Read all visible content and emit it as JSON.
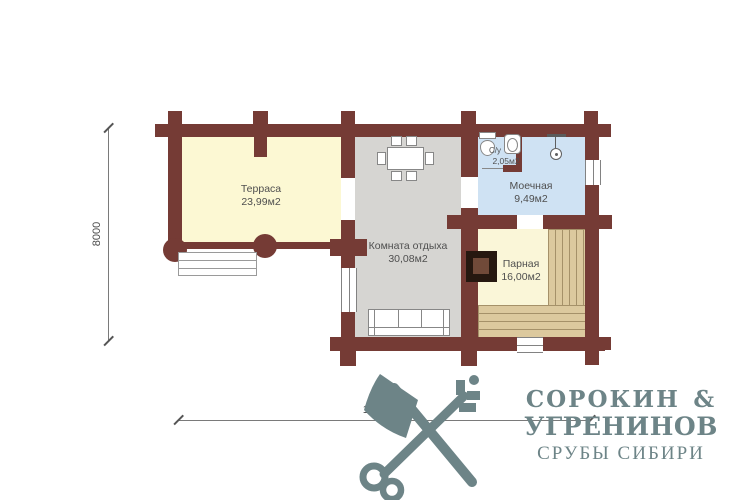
{
  "plan": {
    "rooms": [
      {
        "name": "Терраса",
        "area": "23,99м2"
      },
      {
        "name": "Комната отдыха",
        "area": "30,08м2"
      },
      {
        "name": "Моечная",
        "area": "9,49м2"
      },
      {
        "name": "С/у",
        "area": "2,05м2"
      },
      {
        "name": "Парная",
        "area": "16,00м2"
      }
    ],
    "dimensions": {
      "vertical": "8000",
      "horizontal": "15500"
    }
  },
  "branding": {
    "name_line1": "СОРОКИН &",
    "name_line2": "УГРЕНИНОВ",
    "tagline": "СРУБЫ СИБИРИ"
  },
  "colors": {
    "wall": "#753b35",
    "terrace_fill": "#fcf8d3",
    "lounge_fill": "#d6d5d2",
    "wash_fill": "#cfe2f3",
    "sauna_fill": "#faf6d8",
    "bench_base": "#dcc99e",
    "bench_line": "#a59169",
    "stove_outer": "#261810",
    "stove_inner": "#714a39",
    "logo": "#6d8487",
    "dim_line": "#7a7a7a",
    "label_text": "#4f4f4f"
  }
}
